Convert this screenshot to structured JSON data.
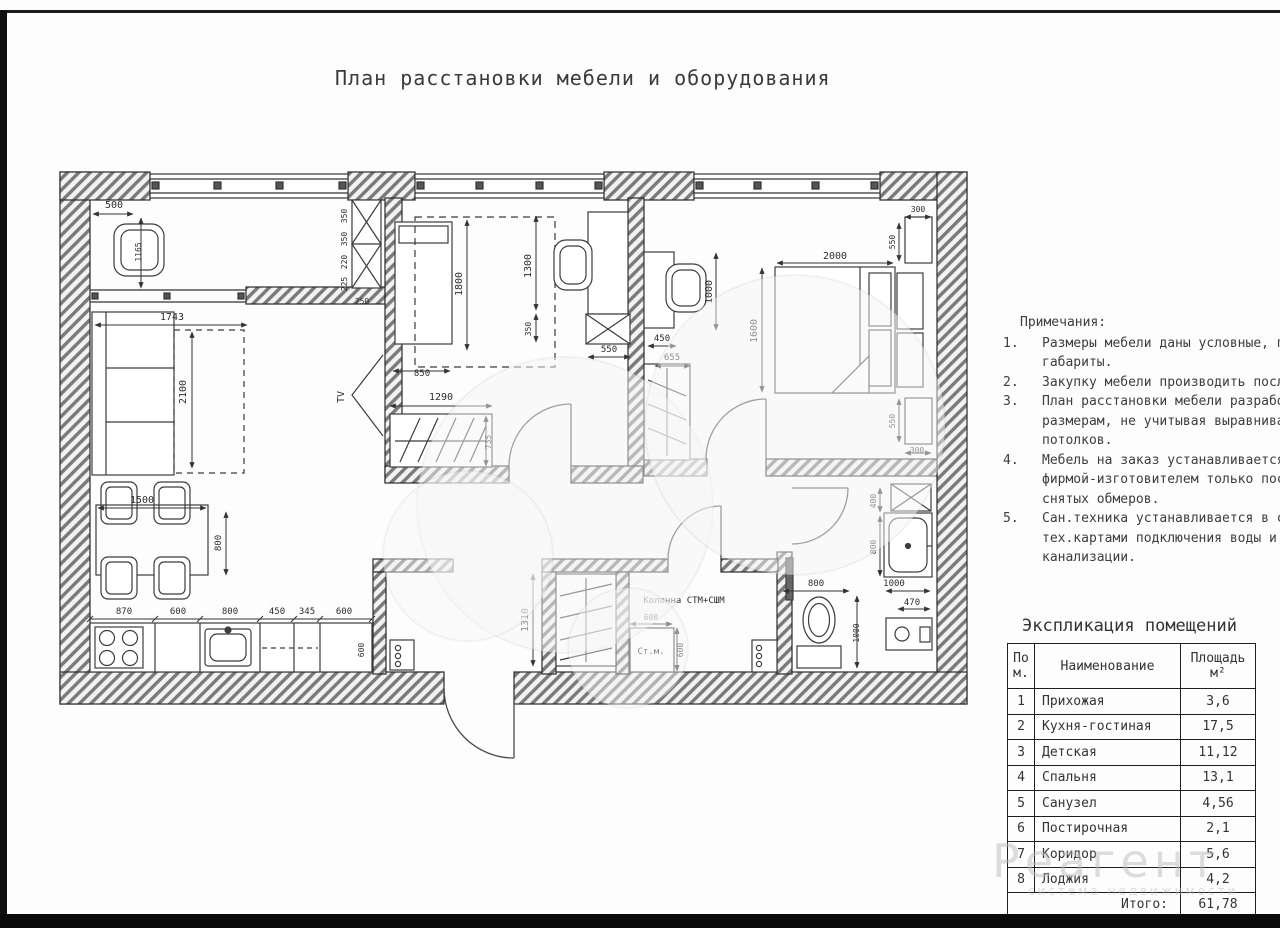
{
  "title": "План расстановки мебели и оборудования",
  "notes": {
    "heading": "Примечания:",
    "items": [
      {
        "num": "1.",
        "lines": [
          "Размеры мебели даны условные, показаны",
          "габариты."
        ]
      },
      {
        "num": "2.",
        "lines": [
          "Закупку мебели производить после чистовой"
        ]
      },
      {
        "num": "3.",
        "lines": [
          "План расстановки мебели разработан по",
          "размерам, не учитывая выравнивание стен",
          "потолков."
        ]
      },
      {
        "num": "4.",
        "lines": [
          "Мебель на заказ устанавливается",
          "фирмой-изготовителем только после",
          "снятых обмеров."
        ]
      },
      {
        "num": "5.",
        "lines": [
          "Сан.техника устанавливается в соответстви",
          "тех.картами подключения воды и вывода",
          "канализации."
        ]
      }
    ]
  },
  "table": {
    "title": "Экспликация помещений",
    "headers": {
      "num": "По\nм.",
      "name": "Наименование",
      "area": "Площадь\nм²"
    },
    "rows": [
      {
        "num": "1",
        "name": "Прихожая",
        "area": "3,6"
      },
      {
        "num": "2",
        "name": "Кухня-гостиная",
        "area": "17,5"
      },
      {
        "num": "3",
        "name": "Детская",
        "area": "11,12"
      },
      {
        "num": "4",
        "name": "Спальня",
        "area": "13,1"
      },
      {
        "num": "5",
        "name": "Санузел",
        "area": "4,56"
      },
      {
        "num": "6",
        "name": "Постирочная",
        "area": "2,1"
      },
      {
        "num": "7",
        "name": "Коридор",
        "area": "5,6"
      },
      {
        "num": "8",
        "name": "Лоджия",
        "area": "4,2"
      }
    ],
    "total_label": "Итого:",
    "total_value": "61,78"
  },
  "watermark": {
    "brand": "Реагент",
    "tagline": "система недвижимости"
  },
  "plan": {
    "labels": [
      {
        "t": "500",
        "x": 114,
        "y": 208
      },
      {
        "t": "1165",
        "x": 141,
        "y": 252,
        "r": 1,
        "s": 8
      },
      {
        "t": "350",
        "x": 347,
        "y": 216,
        "r": 1,
        "s": 8
      },
      {
        "t": "350",
        "x": 347,
        "y": 239,
        "r": 1,
        "s": 8
      },
      {
        "t": "220",
        "x": 347,
        "y": 262,
        "r": 1,
        "s": 8
      },
      {
        "t": "225",
        "x": 347,
        "y": 284,
        "r": 1,
        "s": 8
      },
      {
        "t": "250",
        "x": 362,
        "y": 304,
        "s": 8
      },
      {
        "t": "1743",
        "x": 172,
        "y": 320
      },
      {
        "t": "2100",
        "x": 186,
        "y": 392,
        "r": 1
      },
      {
        "t": "TV",
        "x": 344,
        "y": 397,
        "r": 1
      },
      {
        "t": "1500",
        "x": 142,
        "y": 503
      },
      {
        "t": "800",
        "x": 221,
        "y": 543,
        "r": 1,
        "s": 9
      },
      {
        "t": "870",
        "x": 124,
        "y": 614,
        "s": 9
      },
      {
        "t": "600",
        "x": 178,
        "y": 614,
        "s": 9
      },
      {
        "t": "800",
        "x": 230,
        "y": 614,
        "s": 9
      },
      {
        "t": "450",
        "x": 277,
        "y": 614,
        "s": 9
      },
      {
        "t": "345",
        "x": 307,
        "y": 614,
        "s": 9
      },
      {
        "t": "600",
        "x": 344,
        "y": 614,
        "s": 9
      },
      {
        "t": "600",
        "x": 364,
        "y": 650,
        "r": 1,
        "s": 8
      },
      {
        "t": "850",
        "x": 422,
        "y": 376,
        "s": 9
      },
      {
        "t": "1290",
        "x": 441,
        "y": 400
      },
      {
        "t": "735",
        "x": 491,
        "y": 442,
        "r": 1,
        "s": 8
      },
      {
        "t": "1800",
        "x": 462,
        "y": 284,
        "r": 1
      },
      {
        "t": "1300",
        "x": 531,
        "y": 266,
        "r": 1
      },
      {
        "t": "350",
        "x": 531,
        "y": 329,
        "r": 1,
        "s": 8
      },
      {
        "t": "550",
        "x": 609,
        "y": 352,
        "s": 9
      },
      {
        "t": "450",
        "x": 662,
        "y": 341,
        "s": 9
      },
      {
        "t": "655",
        "x": 672,
        "y": 360,
        "s": 9
      },
      {
        "t": "1000",
        "x": 712,
        "y": 292,
        "r": 1
      },
      {
        "t": "1600",
        "x": 757,
        "y": 331,
        "r": 1
      },
      {
        "t": "2000",
        "x": 835,
        "y": 259
      },
      {
        "t": "300",
        "x": 918,
        "y": 212,
        "s": 8
      },
      {
        "t": "550",
        "x": 895,
        "y": 242,
        "r": 1,
        "s": 8
      },
      {
        "t": "550",
        "x": 895,
        "y": 421,
        "r": 1,
        "s": 8
      },
      {
        "t": "300",
        "x": 917,
        "y": 453,
        "s": 8
      },
      {
        "t": "1310",
        "x": 528,
        "y": 620,
        "r": 1
      },
      {
        "t": "Колонна СТМ+СШМ",
        "x": 684,
        "y": 603,
        "s": 9
      },
      {
        "t": "600",
        "x": 651,
        "y": 620,
        "s": 8
      },
      {
        "t": "Ст.м.",
        "x": 651,
        "y": 654,
        "s": 9
      },
      {
        "t": "600",
        "x": 683,
        "y": 650,
        "r": 1,
        "s": 8
      },
      {
        "t": "400",
        "x": 876,
        "y": 501,
        "r": 1,
        "s": 8
      },
      {
        "t": "800",
        "x": 876,
        "y": 547,
        "r": 1,
        "s": 8
      },
      {
        "t": "800",
        "x": 816,
        "y": 586,
        "s": 9
      },
      {
        "t": "1000",
        "x": 894,
        "y": 586,
        "s": 9
      },
      {
        "t": "470",
        "x": 912,
        "y": 605,
        "s": 9
      },
      {
        "t": "1000",
        "x": 859,
        "y": 633,
        "r": 1,
        "s": 8
      }
    ]
  }
}
